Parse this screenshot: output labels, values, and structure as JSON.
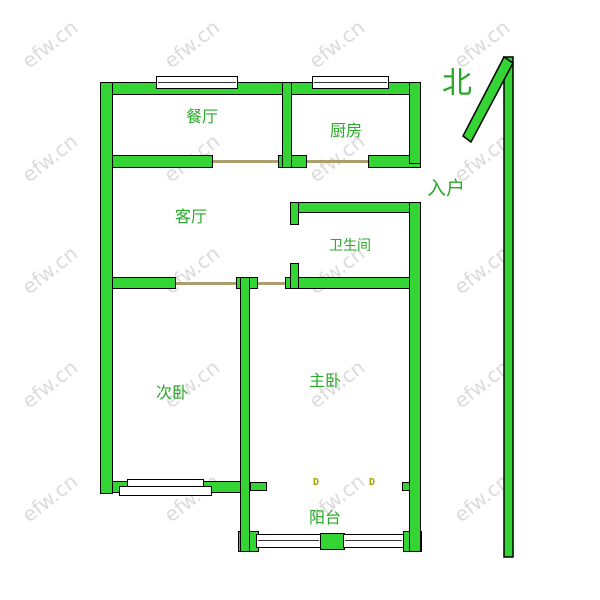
{
  "rooms": {
    "dining": "餐厅",
    "kitchen": "厨房",
    "living": "客厅",
    "bathroom": "卫生间",
    "second_bedroom": "次卧",
    "master_bedroom": "主卧",
    "balcony": "阳台"
  },
  "annotations": {
    "entrance": "入户",
    "north": "北"
  },
  "markers": {
    "door": "D"
  },
  "watermark": {
    "text": "efw.cn"
  },
  "colors": {
    "wall_fill": "#33d433",
    "wall_outline": "#000000",
    "label_text": "#2aa82a",
    "door_line": "#ac9f6e",
    "marker": "#a0a000",
    "watermark": "#dbdbdb"
  }
}
